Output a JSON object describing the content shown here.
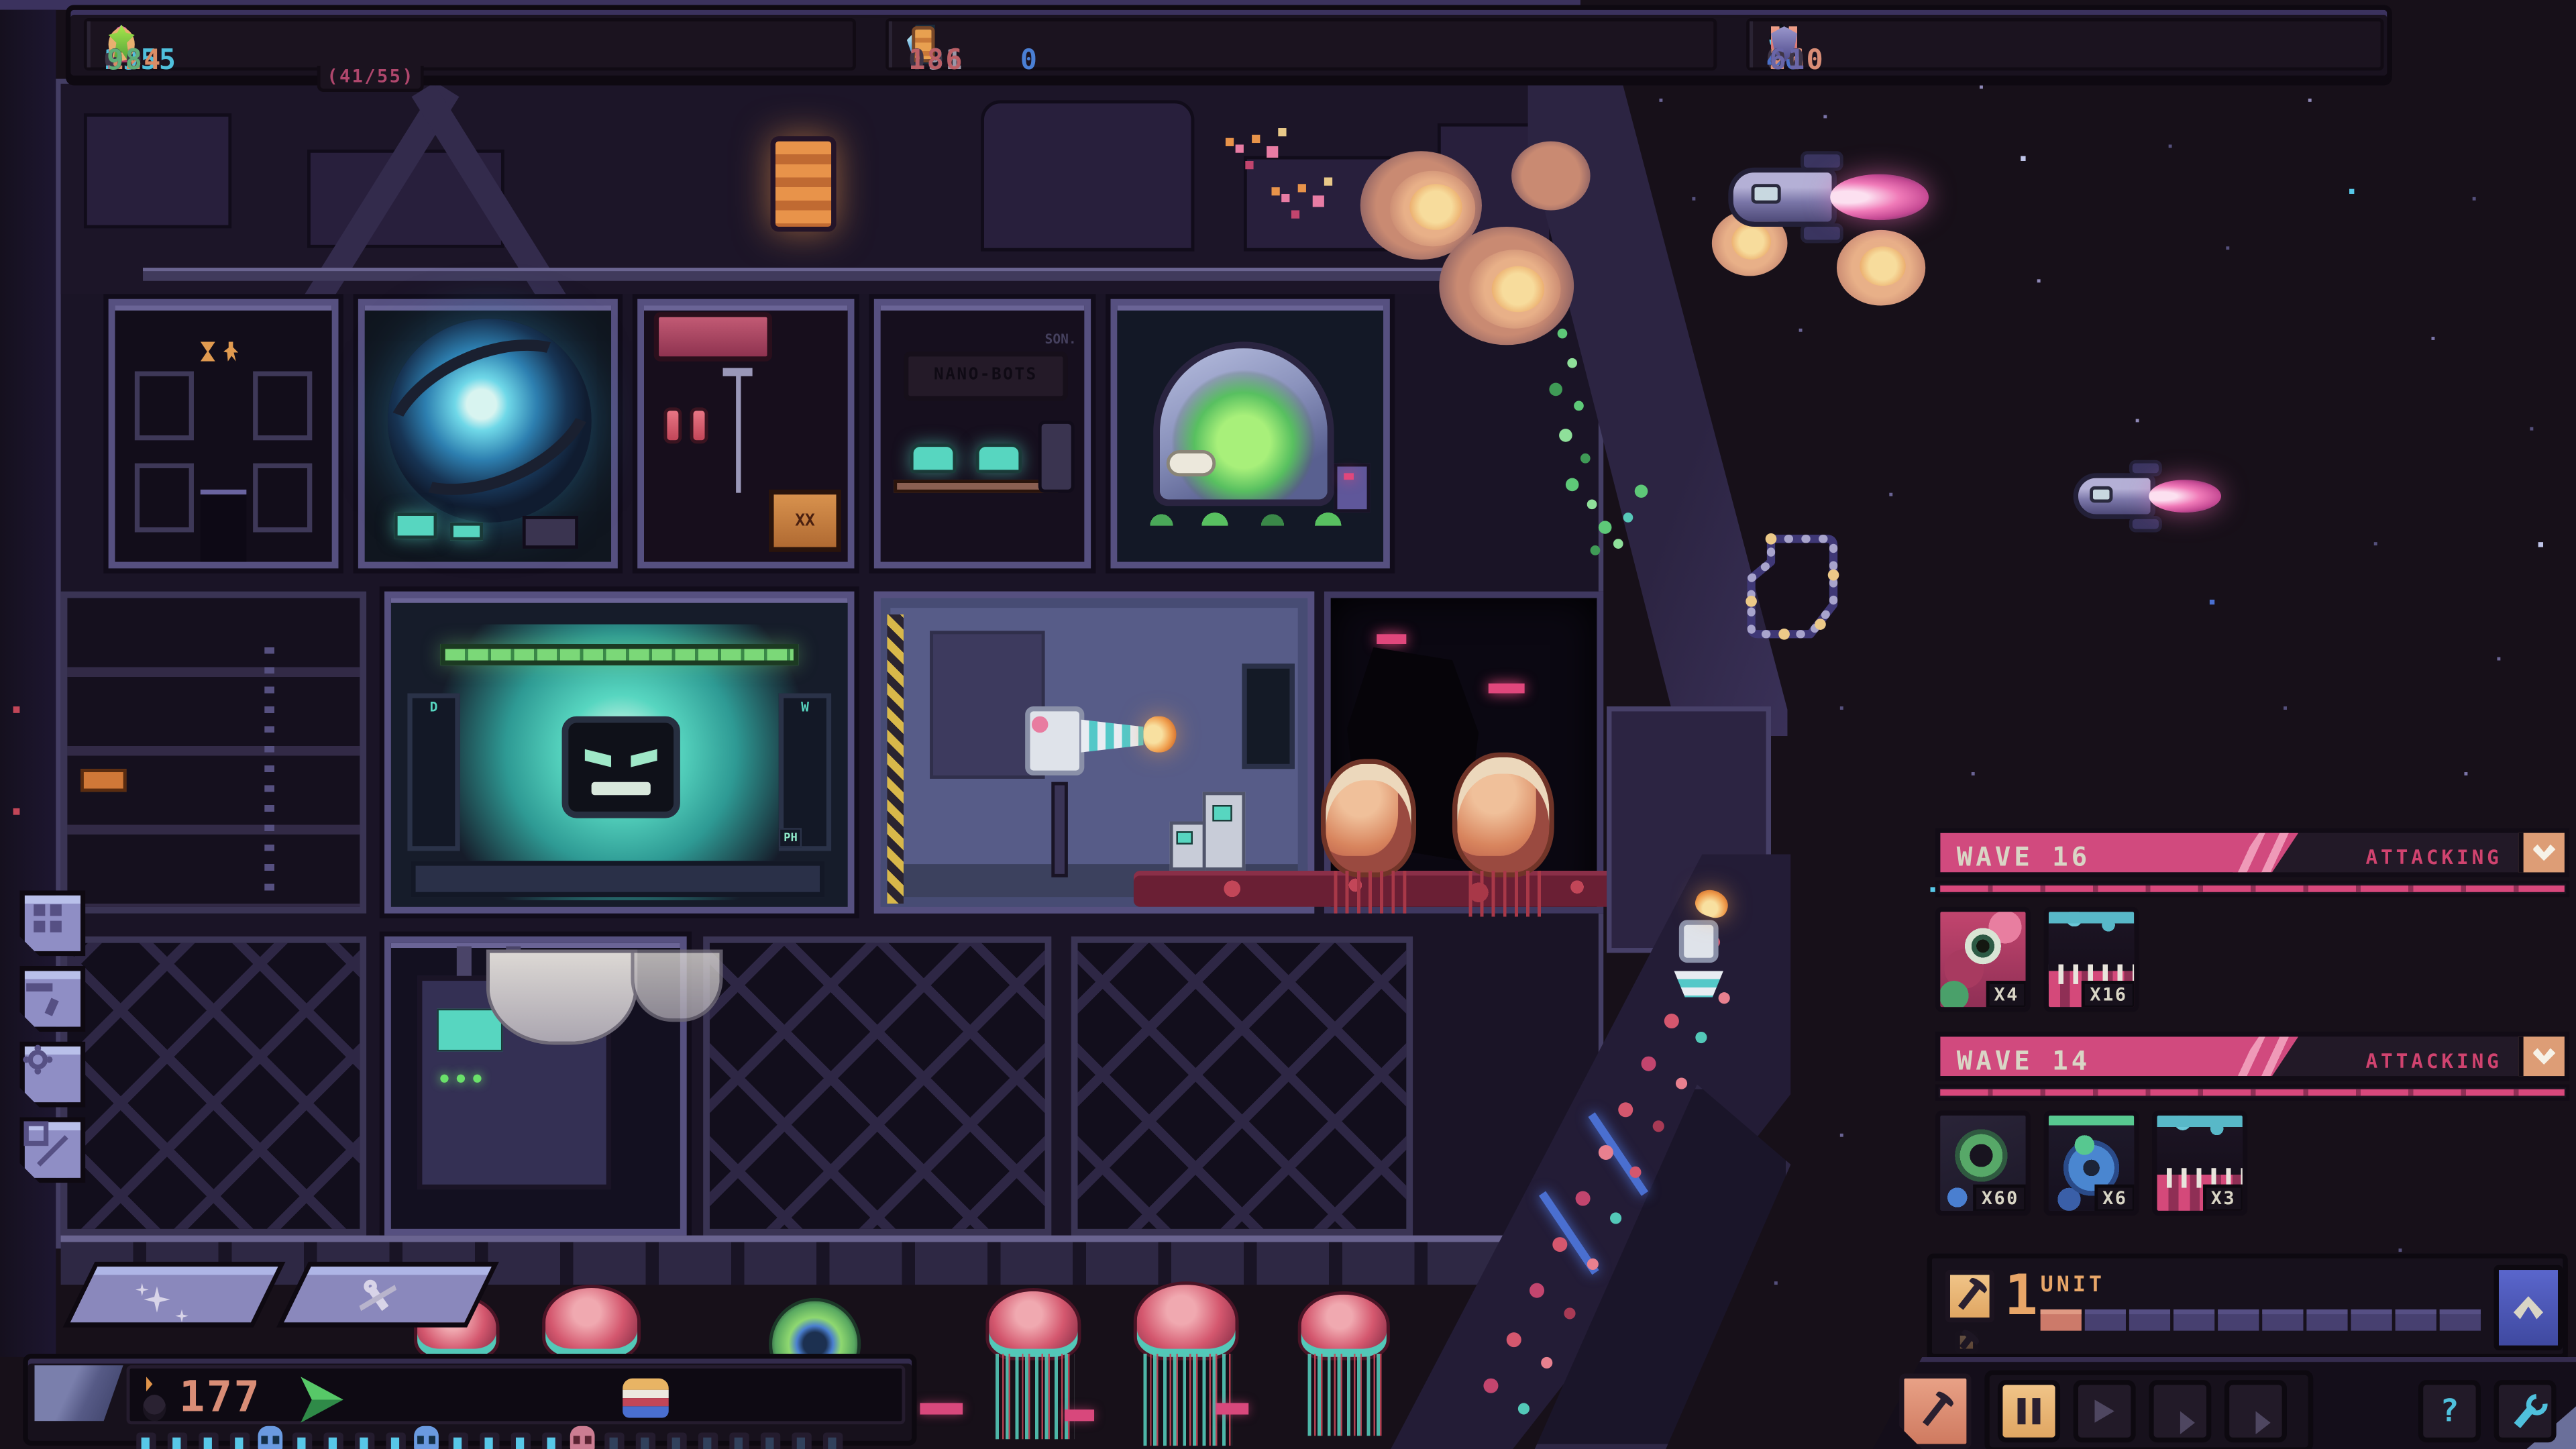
{
  "top_bar": {
    "groups": [
      {
        "resources": [
          {
            "name": "energy",
            "pad": "0",
            "value": "1955"
          },
          {
            "name": "crew",
            "pad": "00",
            "value": "2",
            "sub": "(41/55)"
          },
          {
            "name": "coins",
            "pad": "0",
            "value": "124"
          },
          {
            "name": "biomass",
            "pad": "00",
            "value": "98"
          }
        ]
      },
      {
        "resources": [
          {
            "name": "ice",
            "pad": "",
            "value": "0"
          },
          {
            "name": "minerals",
            "pad": "0",
            "value": "191"
          },
          {
            "name": "glass",
            "pad": "00",
            "value": "18"
          },
          {
            "name": "ammo",
            "pad": "0",
            "value": "186"
          }
        ]
      },
      {
        "resources": [
          {
            "name": "oil",
            "pad": "00",
            "value": "40"
          },
          {
            "name": "trophies",
            "pad": "000",
            "value": "0"
          },
          {
            "name": "magnets",
            "pad": "0",
            "value": "260"
          },
          {
            "name": "shields",
            "pad": "00",
            "value": "61"
          }
        ]
      }
    ]
  },
  "waves": [
    {
      "title": "WAVE 16",
      "status": "ATTACKING",
      "enemies": [
        {
          "type": "eye-monster",
          "count": "X4"
        },
        {
          "type": "maw-monster",
          "count": "X16"
        }
      ]
    },
    {
      "title": "WAVE 14",
      "status": "ATTACKING",
      "enemies": [
        {
          "type": "worm-monster",
          "count": "X60"
        },
        {
          "type": "crab-monster",
          "count": "X6"
        },
        {
          "type": "maw-monster",
          "count": "X3"
        }
      ]
    }
  ],
  "unit_panel": {
    "count": "1",
    "label": "UNIT",
    "segments": 10,
    "filled": 1
  },
  "mining_readout": {
    "value": "177"
  },
  "timeline": {
    "tick_count": 23,
    "dim_after": 15,
    "skulls": [
      {
        "index": 4,
        "variant": "blue"
      },
      {
        "index": 9,
        "variant": "blue"
      },
      {
        "index": 14,
        "variant": "pink"
      }
    ]
  },
  "controls": {
    "help_label": "?"
  },
  "scene": {
    "nanobots_sign": "NANO-BOTS",
    "wall_text": "SON.",
    "ph_monitor": "PH",
    "tank_letter_left": "D",
    "tank_letter_right": "W",
    "cabinet_label": "XX"
  },
  "colors": {
    "accent_pink": "#d14a7e",
    "accent_cyan": "#4fc0dc",
    "accent_orange": "#e9b778",
    "accent_salmon": "#d98d76",
    "accent_green": "#7bd878",
    "hud_bg": "#17111c",
    "banner_text": "#d9d5c5",
    "space_bg": "#171019"
  }
}
